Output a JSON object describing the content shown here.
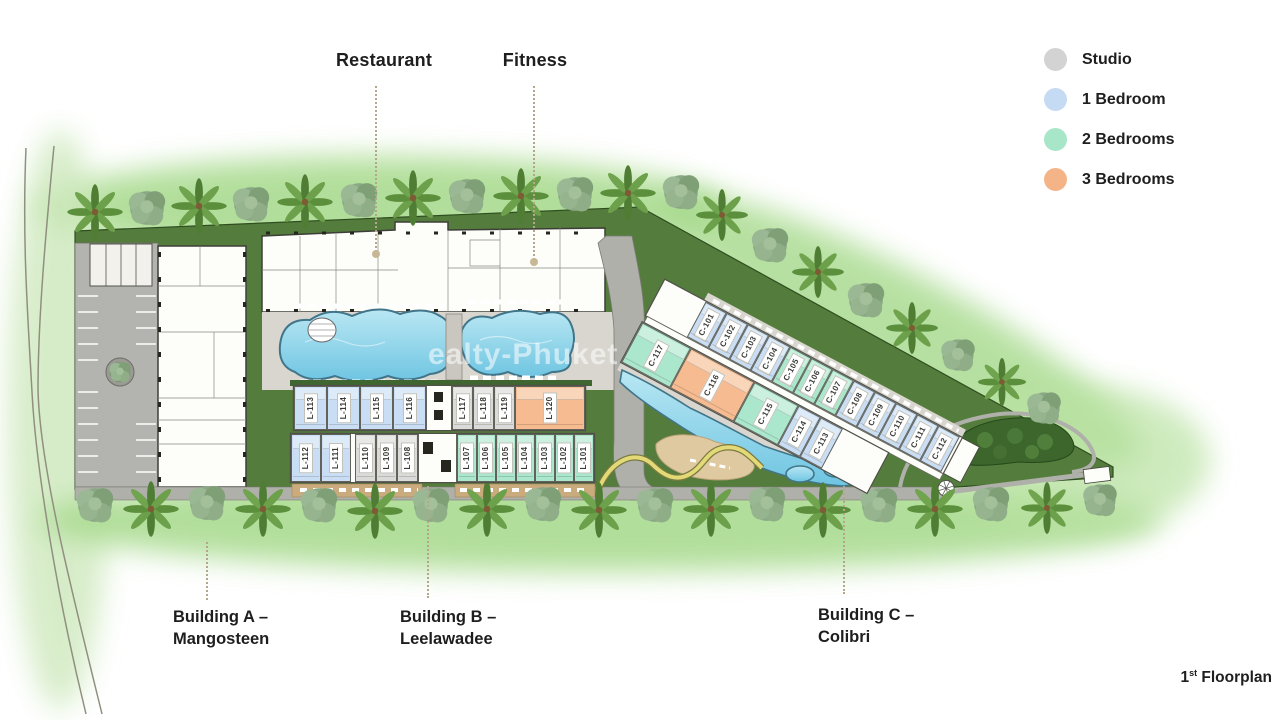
{
  "header": {
    "restaurant": "Restaurant",
    "fitness": "Fitness"
  },
  "legend": [
    {
      "label": "Studio",
      "color": "#d3d3d3"
    },
    {
      "label": "1 Bedroom",
      "color": "#c5daf3"
    },
    {
      "label": "2 Bedrooms",
      "color": "#a7e6c9"
    },
    {
      "label": "3 Bedrooms",
      "color": "#f4b487"
    }
  ],
  "unit_colors": {
    "studio": "#dadad8",
    "one_bed": "#c9def4",
    "two_bed": "#abe7cc",
    "three_bed": "#f6bb90"
  },
  "buildings": {
    "a": {
      "line1": "Building A –",
      "line2": "Mangosteen"
    },
    "b": {
      "line1": "Building B –",
      "line2": "Leelawadee",
      "north_row": [
        {
          "id": "L-113",
          "type": "one_bed"
        },
        {
          "id": "L-114",
          "type": "one_bed"
        },
        {
          "id": "L-115",
          "type": "one_bed"
        },
        {
          "id": "L-116",
          "type": "one_bed"
        },
        {
          "id": "L-117",
          "type": "studio"
        },
        {
          "id": "L-118",
          "type": "studio"
        },
        {
          "id": "L-119",
          "type": "studio"
        },
        {
          "id": "L-120",
          "type": "three_bed"
        }
      ],
      "south_row": [
        {
          "id": "L-112",
          "type": "one_bed"
        },
        {
          "id": "L-111",
          "type": "one_bed"
        },
        {
          "id": "L-110",
          "type": "studio"
        },
        {
          "id": "L-109",
          "type": "studio"
        },
        {
          "id": "L-108",
          "type": "studio"
        },
        {
          "id": "L-107",
          "type": "two_bed"
        },
        {
          "id": "L-106",
          "type": "two_bed"
        },
        {
          "id": "L-105",
          "type": "two_bed"
        },
        {
          "id": "L-104",
          "type": "two_bed"
        },
        {
          "id": "L-103",
          "type": "two_bed"
        },
        {
          "id": "L-102",
          "type": "two_bed"
        },
        {
          "id": "L-101",
          "type": "two_bed"
        }
      ]
    },
    "c": {
      "line1": "Building C –",
      "line2": "Colibri",
      "north_row": [
        {
          "id": "C-101",
          "type": "one_bed"
        },
        {
          "id": "C-102",
          "type": "one_bed"
        },
        {
          "id": "C-103",
          "type": "one_bed"
        },
        {
          "id": "C-104",
          "type": "one_bed"
        },
        {
          "id": "C-105",
          "type": "two_bed"
        },
        {
          "id": "C-106",
          "type": "two_bed"
        },
        {
          "id": "C-107",
          "type": "two_bed"
        },
        {
          "id": "C-108",
          "type": "one_bed"
        },
        {
          "id": "C-109",
          "type": "one_bed"
        },
        {
          "id": "C-110",
          "type": "one_bed"
        },
        {
          "id": "C-111",
          "type": "one_bed"
        },
        {
          "id": "C-112",
          "type": "one_bed"
        }
      ],
      "south_row": [
        {
          "id": "C-117",
          "type": "two_bed"
        },
        {
          "id": "C-116",
          "type": "three_bed"
        },
        {
          "id": "C-115",
          "type": "two_bed"
        },
        {
          "id": "C-114",
          "type": "one_bed"
        },
        {
          "id": "C-113",
          "type": "one_bed"
        }
      ]
    }
  },
  "footer": {
    "floor_number": "1",
    "floor_ordinal": "st",
    "floor_text": "Floorplan"
  },
  "watermark": "ealty-Phuket"
}
